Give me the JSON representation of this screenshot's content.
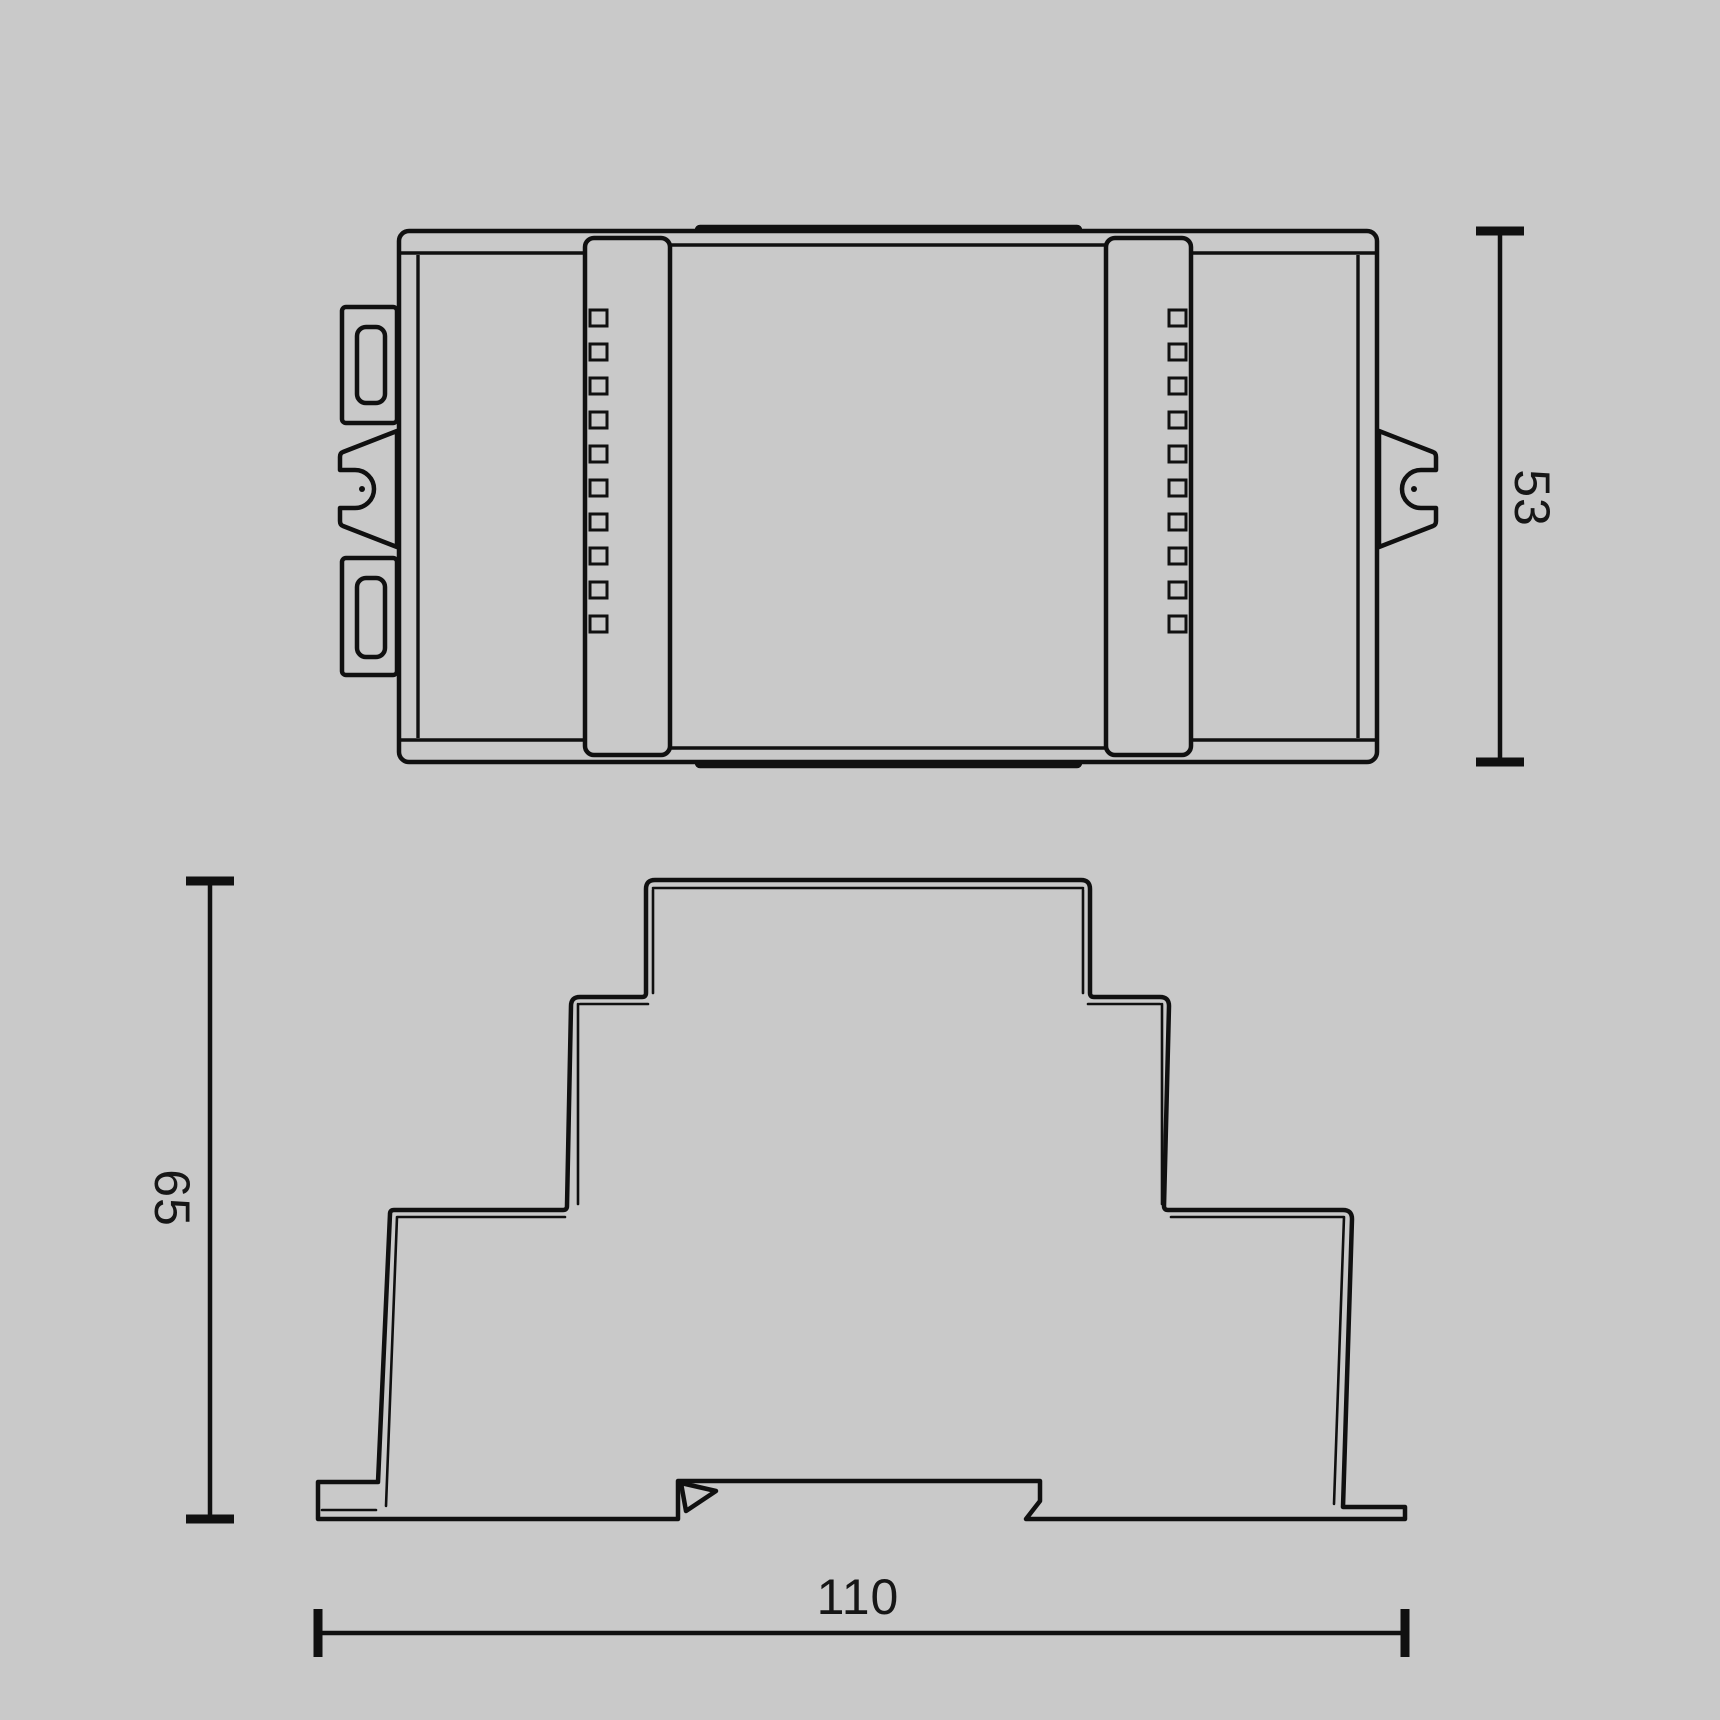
{
  "drawing": {
    "labels": {
      "top_view_depth": "53",
      "front_view_height": "65",
      "front_view_width": "110"
    },
    "colors": {
      "background": "#c9c9c9",
      "line": "#101010",
      "text": "#161616"
    }
  }
}
